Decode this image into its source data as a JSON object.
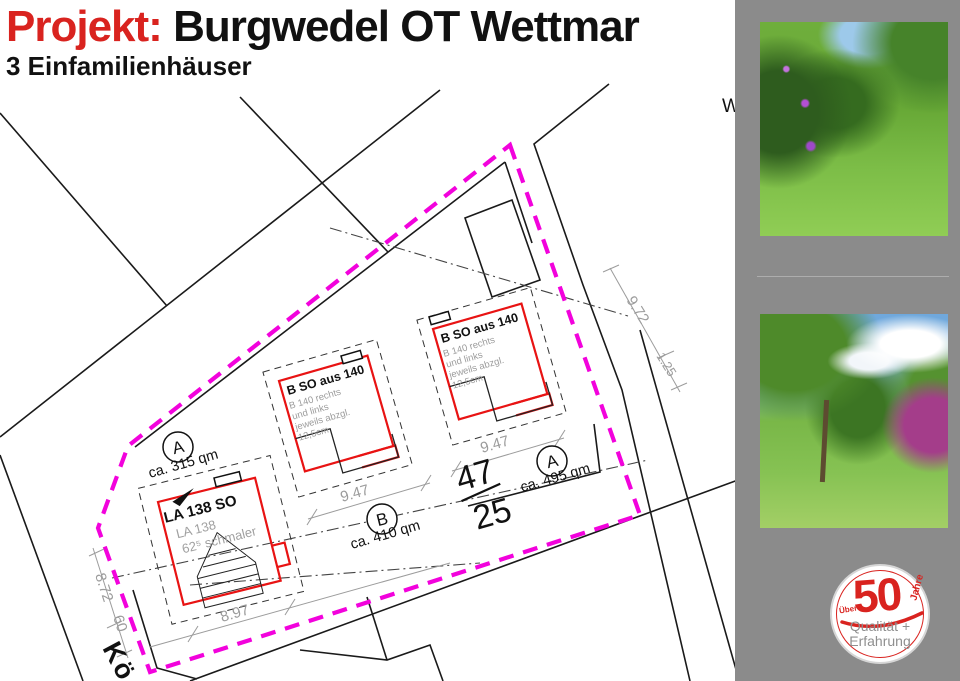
{
  "header": {
    "project_label": "Projekt:",
    "title": "Burgwedel OT Wettmar",
    "subtitle": "3 Einfamilienhäuser"
  },
  "plan": {
    "street_label": "Kö",
    "partial_label": "W",
    "parcel_number_top": "47",
    "parcel_number_bottom": "25",
    "plots": [
      {
        "id": "A",
        "area": "ca. 315 qm"
      },
      {
        "id": "B",
        "area": "ca. 410 qm"
      },
      {
        "id": "A",
        "area": "ca. 495 qm"
      }
    ],
    "buildings": {
      "left": {
        "label": "LA 138 SO",
        "note1": "LA 138",
        "note2": "62⁵ schmaler"
      },
      "middle": {
        "label": "B SO aus 140",
        "notes": [
          "B 140 rechts",
          "und links",
          "jeweils abzgl.",
          "12,5cm"
        ]
      },
      "right": {
        "label": "B SO aus 140",
        "notes": [
          "B 140 rechts",
          "und links",
          "jeweils abzgl.",
          "12,5cm"
        ]
      }
    },
    "dimensions": {
      "d_897": "8.97",
      "d_947_mid": "9.47",
      "d_947_right": "9.47",
      "d_872": "8.72",
      "d_60": "60",
      "d_972": "9.72",
      "d_125": "1.25"
    }
  },
  "sidebar": {
    "photos": [
      {
        "name": "garden meadow with flowering bushes"
      },
      {
        "name": "meadow with tree and rhododendron"
      }
    ],
    "badge": {
      "ueber": "Über",
      "number": "50",
      "jahre": "Jahre",
      "line1": "Qualität +",
      "line2": "Erfahrung"
    }
  },
  "colors": {
    "accent_red": "#d9231f",
    "boundary_magenta": "#f202dc",
    "building_red": "#e81313",
    "dimension_gray": "#9c9c9c",
    "sidebar_gray": "#8b8b8b"
  }
}
